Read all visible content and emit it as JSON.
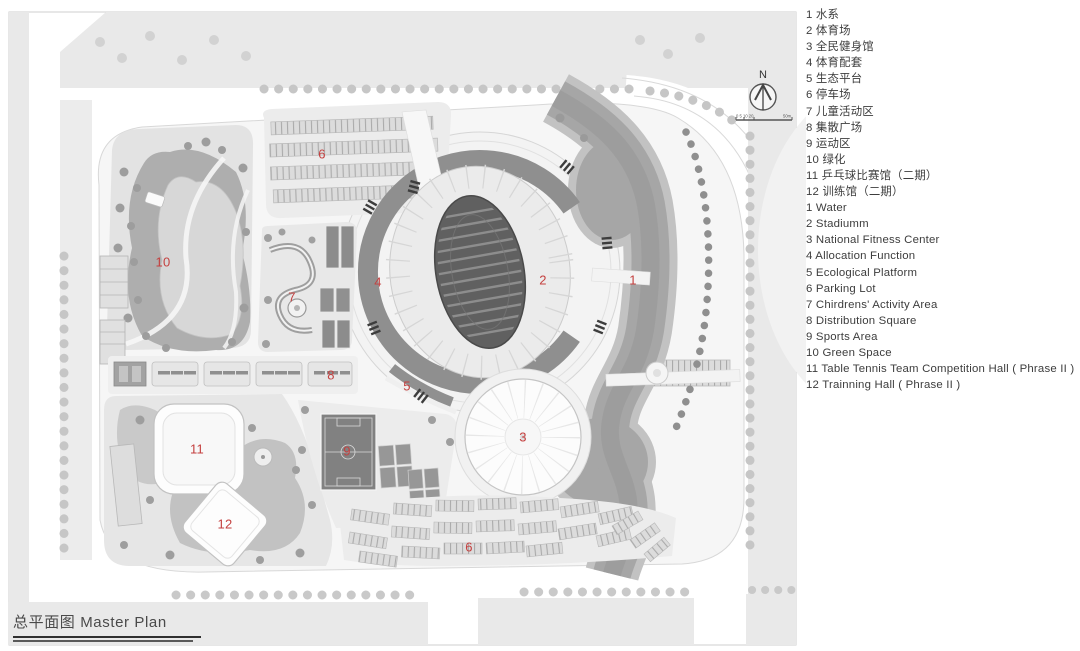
{
  "plan": {
    "title_zh": "总平面图",
    "title_en": "Master Plan",
    "north_label": "N",
    "scale_ticks": "0 5 10 20",
    "scale_end": "50m",
    "accent_label_color": "#c4403f",
    "labels": [
      {
        "num": "1"
      },
      {
        "num": "2"
      },
      {
        "num": "3"
      },
      {
        "num": "4"
      },
      {
        "num": "5"
      },
      {
        "num": "6"
      },
      {
        "num": "7"
      },
      {
        "num": "8"
      },
      {
        "num": "9"
      },
      {
        "num": "10"
      },
      {
        "num": "11"
      },
      {
        "num": "12"
      },
      {
        "num": "6"
      }
    ]
  },
  "legend": {
    "zh_items": [
      {
        "num": "1",
        "label": "水系"
      },
      {
        "num": "2",
        "label": "体育场"
      },
      {
        "num": "3",
        "label": "全民健身馆"
      },
      {
        "num": "4",
        "label": "体育配套"
      },
      {
        "num": "5",
        "label": "生态平台"
      },
      {
        "num": "6",
        "label": "停车场"
      },
      {
        "num": "7",
        "label": "儿童活动区"
      },
      {
        "num": "8",
        "label": "集散广场"
      },
      {
        "num": "9",
        "label": "运动区"
      },
      {
        "num": "10",
        "label": "绿化"
      },
      {
        "num": "11",
        "label": "乒乓球比赛馆（二期）"
      },
      {
        "num": "12",
        "label": "训练馆（二期）"
      }
    ],
    "en_items": [
      {
        "num": "1",
        "label": "Water"
      },
      {
        "num": "2",
        "label": "Stadiumm"
      },
      {
        "num": "3",
        "label": "National Fitness Center"
      },
      {
        "num": "4",
        "label": "Allocation Function"
      },
      {
        "num": "5",
        "label": "Ecological Platform"
      },
      {
        "num": "6",
        "label": "Parking Lot"
      },
      {
        "num": "7",
        "label": "Chirdrens'  Activity Area"
      },
      {
        "num": "8",
        "label": "Distribution Square"
      },
      {
        "num": "9",
        "label": "Sports Area"
      },
      {
        "num": "10",
        "label": "Green Space"
      },
      {
        "num": "11",
        "label": "Table Tennis Team Competition Hall ( Phrase II )"
      },
      {
        "num": "12",
        "label": "Trainning Hall ( Phrase II )"
      }
    ]
  }
}
